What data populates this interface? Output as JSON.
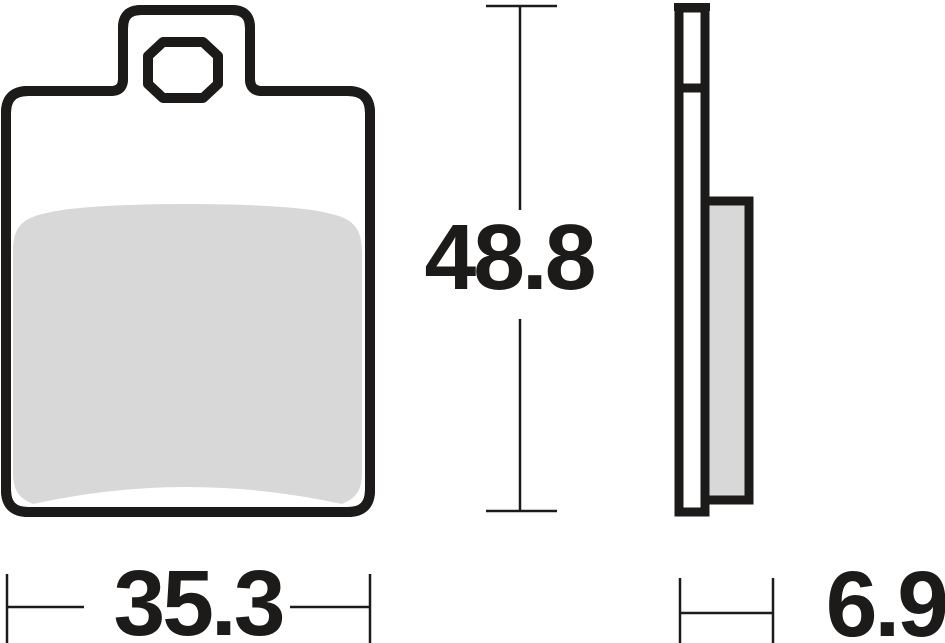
{
  "drawing": {
    "colors": {
      "outline": "#1d1b1a",
      "friction": "#d8d8d8",
      "background": "#ffffff"
    },
    "dimensions": {
      "height": "48.8",
      "width": "35.3",
      "thickness": "6.9"
    }
  }
}
